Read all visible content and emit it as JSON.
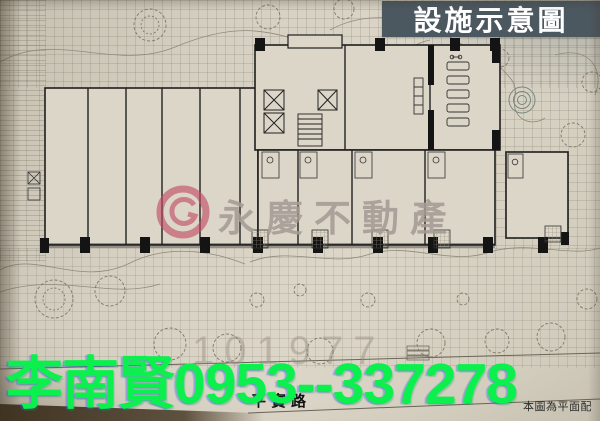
{
  "badge": {
    "label": "設施示意圖",
    "bg_color": "#4c5860",
    "fg_color": "#ffffff"
  },
  "units": [
    {
      "id": "S1"
    },
    {
      "id": "S2"
    },
    {
      "id": "S3"
    },
    {
      "id": "S5"
    },
    {
      "id": "S6"
    },
    {
      "id": "S7"
    },
    {
      "id": "S8"
    },
    {
      "id": "S9"
    },
    {
      "id": "S10"
    },
    {
      "id": "S11"
    }
  ],
  "rooms": {
    "stair_a": "A梯",
    "stair_lobby": "梯廳",
    "banquet": "宴會廳使用空間",
    "pantry": "備餐區",
    "gym": "健身房",
    "sport_bar": "Sport Bar(視聽)"
  },
  "street": {
    "label": "平實路"
  },
  "caption": {
    "label": "本圖為平面配"
  },
  "watermark": {
    "brand": "永慶不動產",
    "number": "101977",
    "brand_color": "#a59c95",
    "logo_color": "#c24a63"
  },
  "contact": {
    "name": "李南賢",
    "phone": "0953--337278",
    "color": "#0bf04c"
  }
}
